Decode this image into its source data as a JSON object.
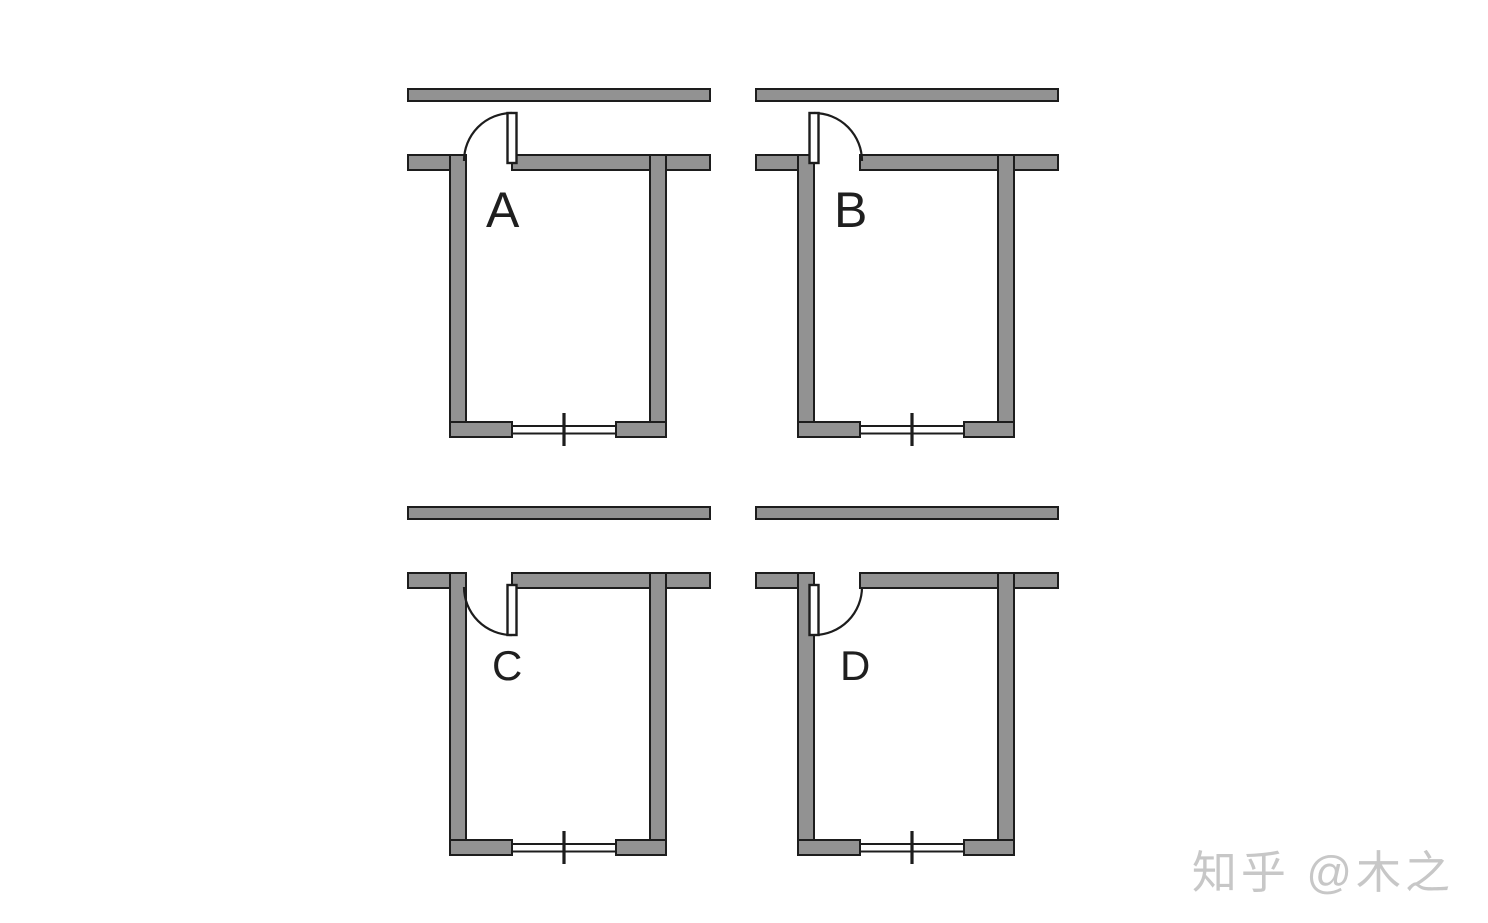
{
  "figure": {
    "description": "Four floor-plan diagrams (A, B, C, D) of the same room on a corridor, showing four door-swing options; each room has a window with a center mullion in the bottom wall",
    "rooms": [
      {
        "label": "A",
        "door_swing": "outward",
        "door_hinge": "right"
      },
      {
        "label": "B",
        "door_swing": "outward",
        "door_hinge": "left"
      },
      {
        "label": "C",
        "door_swing": "inward",
        "door_hinge": "right"
      },
      {
        "label": "D",
        "door_swing": "inward",
        "door_hinge": "left"
      }
    ],
    "colors": {
      "wall_fill": "#929292",
      "wall_outline": "#1d1d1d",
      "door_leaf_fill": "#ffffff",
      "label": "#1f1f1f",
      "background": "#ffffff"
    }
  },
  "watermark": {
    "text": "知乎 @木之",
    "color": "#c7c7c7"
  }
}
